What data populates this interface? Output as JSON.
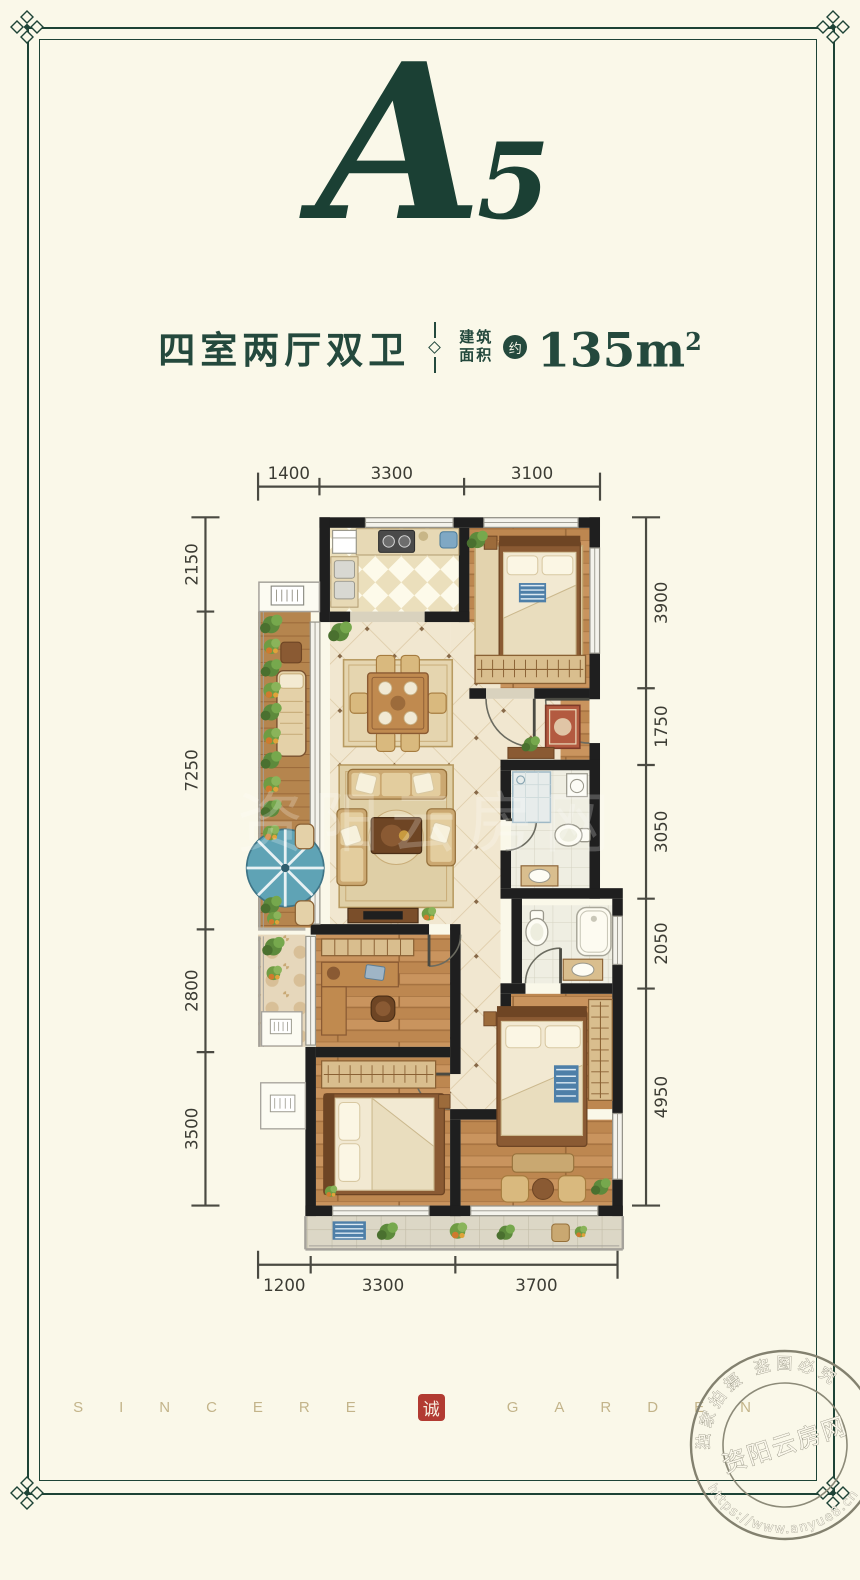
{
  "header": {
    "unit": "A5"
  },
  "title": {
    "layout_name": "四室两厅双卫",
    "area_label_line1": "建筑",
    "area_label_line2": "面积",
    "area_approx": "约",
    "area_value": "135m",
    "area_exponent": "2"
  },
  "plan": {
    "top_dims": [
      "1400",
      "3300",
      "3100"
    ],
    "bottom_dims": [
      "1200",
      "3300",
      "3700"
    ],
    "left_dims": [
      "2150",
      "7250",
      "2800",
      "3500"
    ],
    "right_dims": [
      "3900",
      "1750",
      "3050",
      "2050",
      "4950"
    ],
    "watermark": "资阳云房网"
  },
  "footer": {
    "brand_left": "SINCERE",
    "seal_char": "诚",
    "brand_right": "GARDEN"
  },
  "stamp": {
    "arc_top": "独家拍摄 盗图必究",
    "site_name": "资阳云房网",
    "url": "https://www.anyue8.cn"
  },
  "colors": {
    "accent_green": "#1d4336",
    "seal_red": "#b23b32",
    "background": "#faf8e9"
  }
}
